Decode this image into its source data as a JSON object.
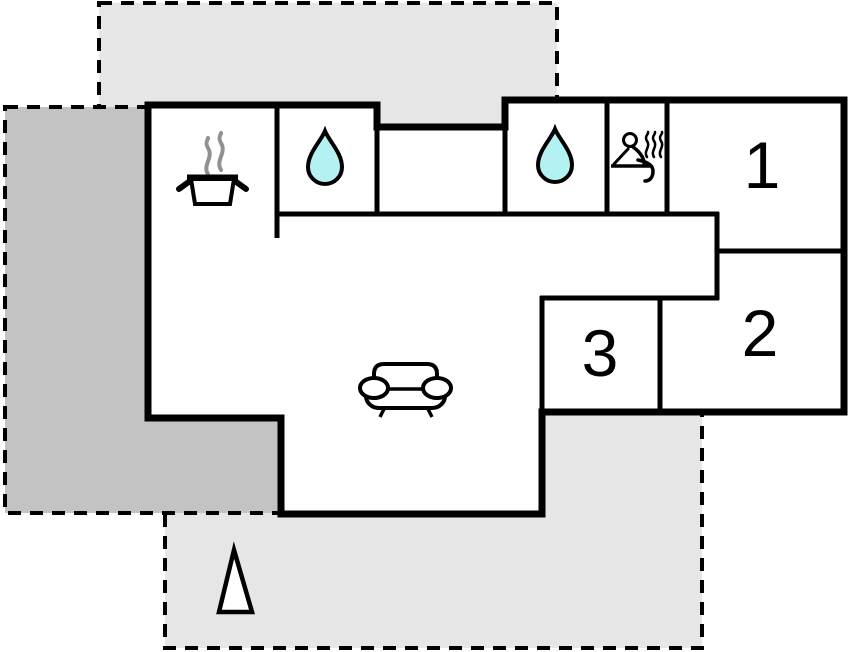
{
  "title": "holiday-home-floor-plan",
  "rooms": [
    {
      "label": "1"
    },
    {
      "label": "2"
    },
    {
      "label": "3"
    }
  ],
  "icons": {
    "kitchen": "cooking-pot-with-steam",
    "bathroom_1": "water-drop",
    "bathroom_2": "water-drop",
    "sauna": "person-on-bench-with-steam",
    "living_room": "sofa",
    "orientation": "north-arrow-triangle"
  },
  "colors": {
    "terrace_light": "#e6e6e6",
    "terrace_dark": "#c3c3c3",
    "water_drop": "#b3f1f3",
    "wall": "#000000",
    "steam_gray": "#919191"
  }
}
